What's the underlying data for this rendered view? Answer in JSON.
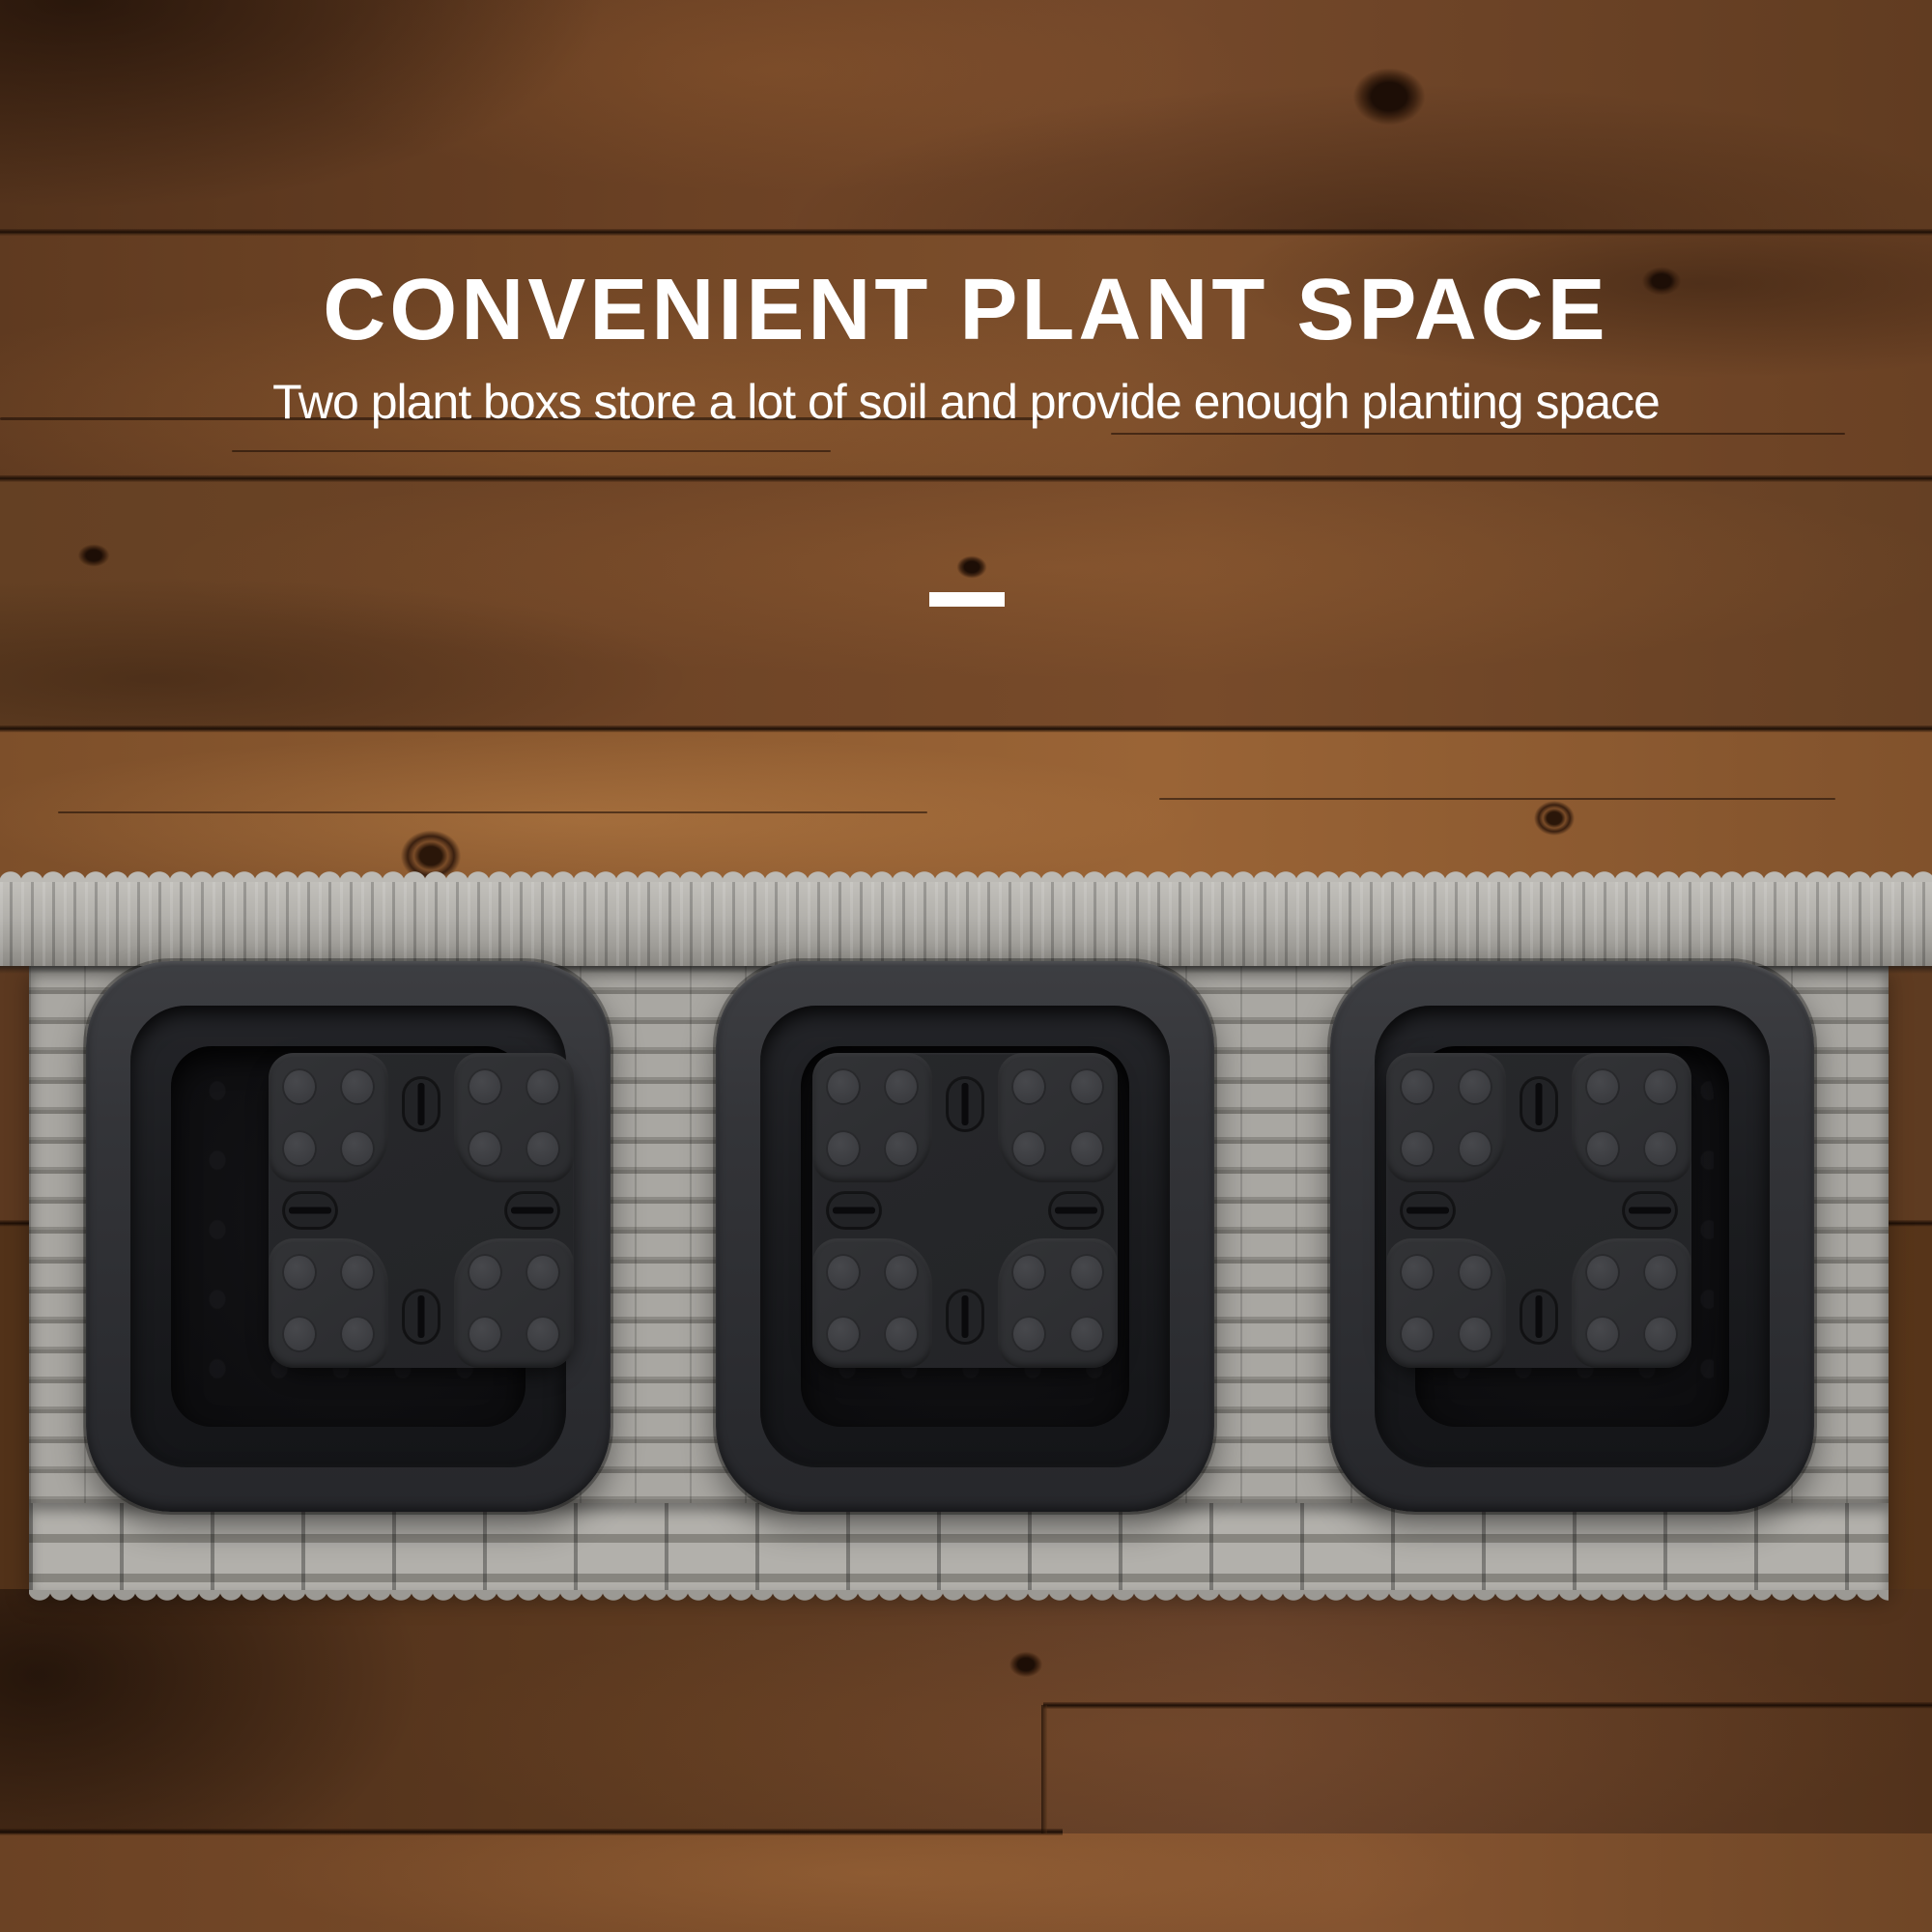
{
  "banner": {
    "title": "CONVENIENT PLANT SPACE",
    "subtitle": "Two plant boxs store a lot of soil and provide enough planting space",
    "text_color": "#ffffff",
    "divider": {
      "type": "dash",
      "color": "#ffffff"
    }
  },
  "scene": {
    "background": "stained-wood-planks",
    "colors": {
      "wood_dark": "#5d3a20",
      "wood_mid": "#6e4426",
      "wood_light": "#8f5c31",
      "wicker_light": "#b3b1ac",
      "wicker_mid": "#a6a49f",
      "wicker_shadow": "#7b7975",
      "pot_body": "#2c2d31",
      "pot_cavity": "#0c0c0e",
      "pot_insert": "#2f3033"
    },
    "planter": {
      "type": "rattan-wicker-planter-top-view",
      "pot_count": 3,
      "insert": {
        "pads": 4,
        "dots_per_pad": 4,
        "slots": 4
      }
    }
  }
}
